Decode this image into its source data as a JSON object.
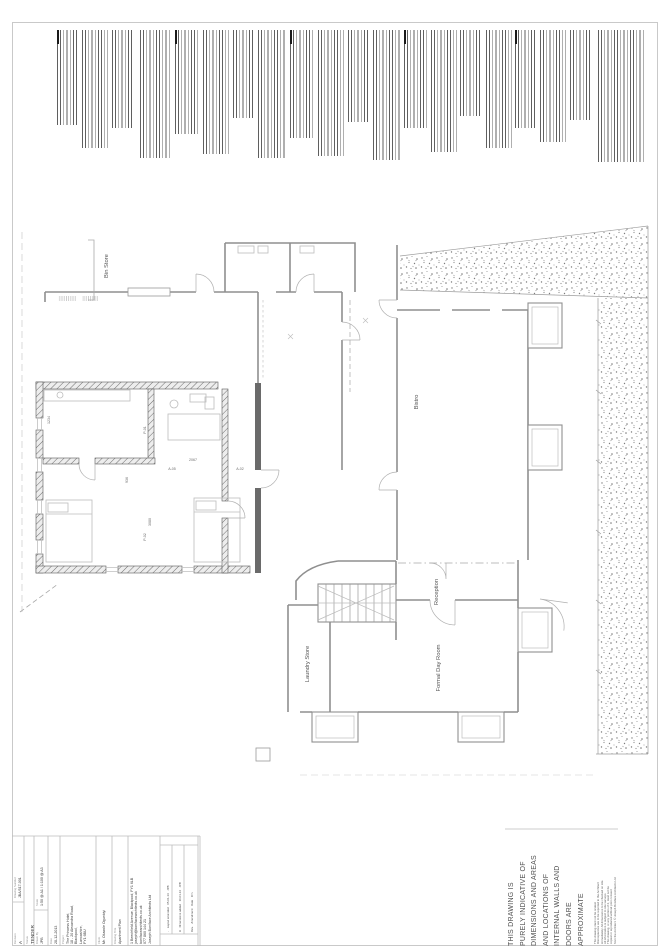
{
  "page": {
    "background": "#ffffff",
    "border_color": "#bcbcbc"
  },
  "indicative_note": {
    "lines": [
      "THIS DRAWING IS",
      "PURELY INDICATIVE OF",
      "DIMENSIONS AND AREAS",
      "AND LOCATIONS OF",
      "INTERNAL WALLS AND",
      "DOORS ARE",
      "APPROXIMATE"
    ]
  },
  "copyright_note": {
    "lines": [
      "This drawing must not be scaled.",
      "Discrepancies are to be reported to the Architect",
      "immediately. All dimensions to be checked on site.",
      "All information is subject to site surveys.",
      "This drawing, or any portion of it, must not be",
      "copied or reproduced without prior consent",
      "from the Architect. © Joseph Boniface Architects Ltd"
    ]
  },
  "title_block": {
    "drawing_number_label": "Drawing Number",
    "drawing_number": "JBA/517-001",
    "revision_label": "Revision",
    "revision": "A",
    "status_label": "Status",
    "status": "TENDER",
    "scale_label": "Scale",
    "scale": "1:50 @ A1 / 1:100 @ A3",
    "drawn_label": "Drawn By",
    "drawn_by": "JPB",
    "date_label": "Date",
    "date": "28-12-2013",
    "project_label": "Project",
    "project_lines": [
      "The Princess Hotel,",
      "18 - 20 Alexandra Road,",
      "Blackpool,",
      "Lancashire,",
      "FY1 6BU"
    ],
    "client_label": "Client",
    "client": "Mr. Oluwole Ogunbiyi",
    "drawing_title_label": "Drawing Title",
    "drawing_title": "Apartment Plan",
    "architect": {
      "name": "Joseph Boniface Architects Ltd",
      "phone": "077 860 144 21",
      "web": "bonifacearchitects.co.uk",
      "email": "joseph@bonifacearchitects.co.uk",
      "address": "1 Beechfield Avenue, Blackpool, FY1 6LB"
    },
    "revisions": {
      "headers": [
        "Rev.",
        "Amendment",
        "Date",
        "Drn"
      ],
      "rows": [
        [
          "A",
          "Dimensions added",
          "10-01-14",
          "JPB"
        ],
        [
          "-",
          "Layout amended",
          "05-01-14",
          "JPB"
        ]
      ]
    }
  },
  "plan": {
    "room_labels": [
      {
        "text": "Bistro",
        "x": 418,
        "y": 402
      },
      {
        "text": "Reception",
        "x": 438,
        "y": 592
      },
      {
        "text": "Laundry Store",
        "x": 309,
        "y": 664
      },
      {
        "text": "Formal Day Room",
        "x": 440,
        "y": 668
      },
      {
        "text": "Bin Store",
        "x": 108,
        "y": 266
      }
    ],
    "dim_labels": [
      {
        "text": "1234",
        "x": 50,
        "y": 420,
        "rot": true
      },
      {
        "text": "3080",
        "x": 151,
        "y": 522,
        "rot": true
      },
      {
        "text": "936",
        "x": 128,
        "y": 480,
        "rot": true
      },
      {
        "text": "P-01",
        "x": 146,
        "y": 430,
        "rot": true
      },
      {
        "text": "P-02",
        "x": 146,
        "y": 537,
        "rot": true
      },
      {
        "text": "2067",
        "x": 193,
        "y": 461,
        "rot": false
      },
      {
        "text": "A-05",
        "x": 172,
        "y": 470,
        "rot": false
      },
      {
        "text": "A-02",
        "x": 240,
        "y": 470,
        "rot": false
      }
    ]
  }
}
